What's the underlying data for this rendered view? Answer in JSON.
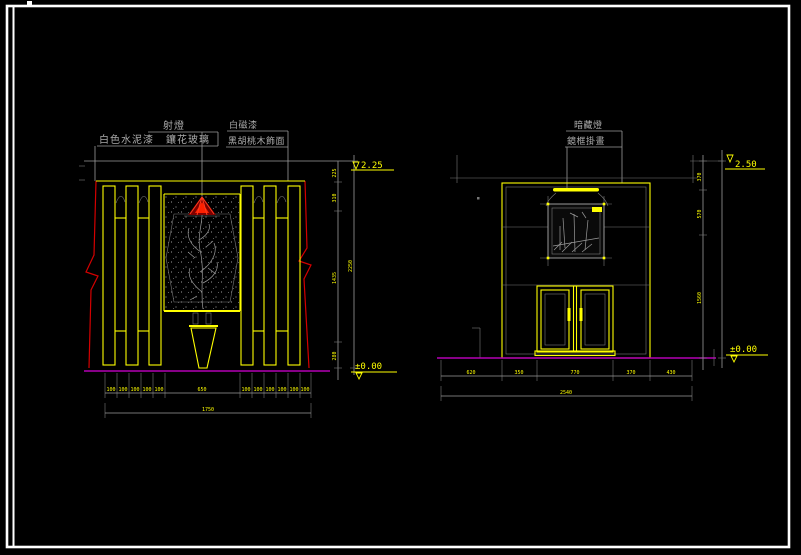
{
  "sheet": {
    "type_note": "CAD elevation sheet"
  },
  "left_view": {
    "labels": {
      "spotlight": "射燈",
      "white_cement_paint": "白色水泥漆",
      "carved_glass": "鑲花玻璃",
      "white_enamel_paint": "白磁漆",
      "black_walnut_veneer": "黑胡桃木飾面"
    },
    "level_top": "2.25",
    "level_bottom": "±0.00",
    "dims_bottom": [
      "100",
      "100",
      "100",
      "100",
      "100",
      "650",
      "100",
      "100",
      "100",
      "100",
      "100",
      "100"
    ],
    "dims_bottom_total": "1750",
    "dims_side": [
      "225",
      "310",
      "1435",
      "280"
    ],
    "dims_side_total": "2250"
  },
  "right_view": {
    "labels": {
      "concealed_light": "暗藏燈",
      "framed_picture": "鏡框掛畫"
    },
    "level_top": "2.50",
    "level_bottom": "±0.00",
    "dims_bottom": [
      "620",
      "350",
      "770",
      "370",
      "430"
    ],
    "dims_bottom_total": "2540",
    "dims_side": [
      "370",
      "570",
      "1560"
    ]
  },
  "colors": {
    "background": "#000000",
    "sheet_border": "#ffffff",
    "line_yellow": "#ffff00",
    "line_gray": "#9a9a9a",
    "line_red": "#d40000",
    "lamp_red": "#ff2400",
    "floor_magenta": "#b400b4"
  }
}
